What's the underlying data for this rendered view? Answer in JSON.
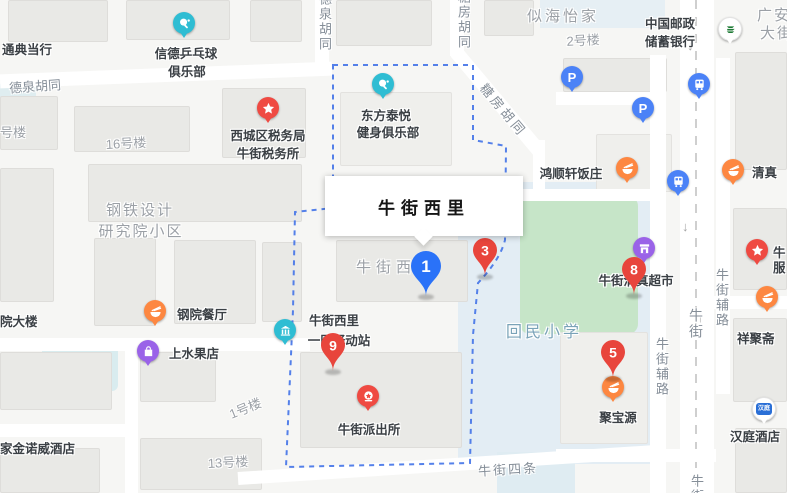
{
  "info_window": {
    "title": "牛街西里"
  },
  "markers": {
    "m1": {
      "label": "1",
      "color": "#2a72f8"
    },
    "m3": {
      "label": "3",
      "color": "#e8453c"
    },
    "m5": {
      "label": "5",
      "color": "#e8453c"
    },
    "m8": {
      "label": "8",
      "color": "#e8453c"
    },
    "m9": {
      "label": "9",
      "color": "#e8453c"
    }
  },
  "pois": {
    "pingpong_club": {
      "line1": "信德乒乓球",
      "line2": "俱乐部",
      "icon": "sports-icon"
    },
    "fitness_club": {
      "line1": "东方泰悦",
      "line2": "健身俱乐部",
      "icon": "sports-icon"
    },
    "tax_office": {
      "line1": "西城区税务局",
      "line2": "牛街税务所",
      "icon": "star-icon"
    },
    "postal_bank": {
      "line1": "中国邮政",
      "line2": "储蓄银行",
      "icon": "postal-icon"
    },
    "pawnshop": {
      "line1": "通典当行"
    },
    "hongshunxuan_restaurant": {
      "line1": "鸿顺轩饭庄",
      "icon": "food-icon"
    },
    "qingzhen_restaurant": {
      "line1": "清真",
      "icon": "food-icon"
    },
    "niujie_halal_supermarket": {
      "line1": "牛街清真超市",
      "icon": "market-icon"
    },
    "gangyuan_restaurant": {
      "line1": "钢院餐厅",
      "icon": "food-icon"
    },
    "fruit_shop": {
      "line1": "上水果店",
      "icon": "bag-icon"
    },
    "yidong_station": {
      "line1": "牛街西里",
      "line2": "一区驿动站",
      "icon": "station-icon"
    },
    "police_station": {
      "line1": "牛街派出所",
      "icon": "police-icon"
    },
    "jubaoyuan_restaurant": {
      "line1": "聚宝源",
      "icon": "food-icon"
    },
    "xiangjuzhai": {
      "line1": "祥聚斋",
      "icon": "food-icon"
    },
    "hanting_hotel": {
      "line1": "汉庭酒店",
      "logo": "汉庭",
      "icon": "hotel-icon"
    },
    "jinnuowei_hotel": {
      "line1": "家金诺威酒店"
    },
    "clipped_poi": {
      "line1": "牛",
      "line2": "服",
      "icon": "star-icon"
    },
    "parking_glyph": "P"
  },
  "streets": {
    "dequan_hutong": "德泉胡同",
    "tangfang_hutong": "糖房胡同",
    "guangan_street_line1": "广安",
    "guangan_street_line2": "大街",
    "niujie": "牛街",
    "niujie_fulu": "牛街辅路",
    "niujie_sitiao": "牛街四条"
  },
  "areas": {
    "sihaiyijia": "似海怡家",
    "building_2": "2号楼",
    "building_16": "16号楼",
    "building_clipped": "号楼",
    "steel_institute_line1": "钢铁设计",
    "steel_institute_line2": "研究院小区",
    "niujie_xili": "牛街西里",
    "building_1": "1号楼",
    "building_13": "13号楼",
    "huimin_school": "回民小学",
    "yuan_dalou": "院大楼"
  },
  "colors": {
    "marker_red": "#e8453c",
    "marker_blue": "#2a72f8",
    "poi_orange": "#fd8741",
    "poi_teal": "#2fbdd3",
    "poi_purple": "#9a63e8",
    "poi_blue": "#4b82f7",
    "poi_red": "#ef4a42",
    "postal_green": "#1e7a35",
    "hanting_blue": "#2a6fd6",
    "boundary_blue": "#4273e8",
    "green_field": "#c6e5c8",
    "school_zone_blue": "#e3edf4",
    "road_white": "#ffffff",
    "map_bg": "#f6f6f4"
  }
}
